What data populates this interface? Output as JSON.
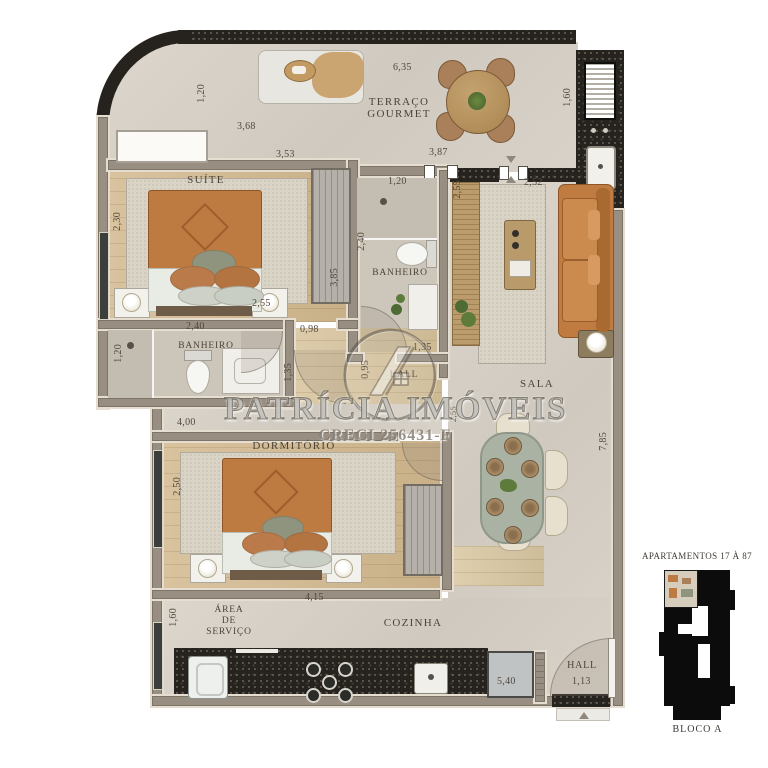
{
  "watermark": {
    "brand": "PATRÍCIA IMÓVEIS",
    "creci": "CRECI 256431-F"
  },
  "keyplan": {
    "title": "APARTAMENTOS 17 À 87",
    "bloco": "BLOCO A"
  },
  "labels": {
    "terraco_l1": "TERRAÇO",
    "terraco_l2": "GOURMET",
    "suite": "SUÍTE",
    "banheiro_suite": "BANHEIRO",
    "banheiro2": "BANHEIRO",
    "sala": "SALA",
    "dormitorio": "DORMITÓRIO",
    "area_l1": "ÁREA",
    "area_l2": "DE",
    "area_l3": "SERVIÇO",
    "cozinha": "COZINHA",
    "hall_inner": "HALL",
    "hall_entry": "HALL"
  },
  "dims": {
    "t_120": "1,20",
    "t_368": "3,68",
    "t_635": "6,35",
    "t_353": "3,53",
    "t_387": "3,87",
    "grill_160": "1,60",
    "b2_120": "1,20",
    "b2_240": "2,40",
    "b2_135": "1,35",
    "sala_252": "2,52",
    "sala_255": "2,55",
    "sala_785": "7,85",
    "su_230": "2,30",
    "su_255": "2,55",
    "su_385": "3,85",
    "su_098": "0,98",
    "bs_240": "2,40",
    "bs_120": "1,20",
    "cor_135": "1,35",
    "hall_095": "0,95",
    "din_255": "2,55",
    "dor_400": "4,00",
    "dor_250": "2,50",
    "coz_415": "4,15",
    "coz_540": "5,40",
    "as_160": "1,60",
    "hall_113": "1,13"
  },
  "colors": {
    "wall_dark": "#26231e",
    "wall_gray": "#988e82",
    "accent_orange": "#c07c40",
    "wood_floor": "#d3b98f",
    "table_sage": "#aab2a3",
    "text": "#4c4438"
  }
}
